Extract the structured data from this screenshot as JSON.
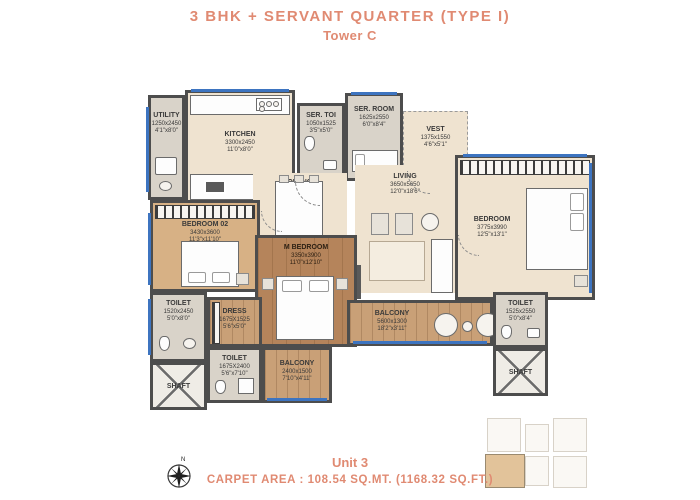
{
  "header": {
    "title": "3 BHK + SERVANT QUARTER (TYPE I)",
    "subtitle": "Tower C"
  },
  "footer": {
    "unit": "Unit 3",
    "carpet_area": "CARPET AREA : 108.54 SQ.MT. (1168.32 SQ.FT.)"
  },
  "colors": {
    "accent": "#E08A72",
    "wall": "#4d4d4d",
    "floor_beige": "#efe3d0",
    "floor_wood": "#c9a077",
    "window_blue": "#3d74c0"
  },
  "compass": {
    "label": "N"
  },
  "rooms": {
    "utility": {
      "name": "UTILITY",
      "mm": "1250x2450",
      "ft": "4'1\"x8'0\""
    },
    "kitchen": {
      "name": "KITCHEN",
      "mm": "3300x2450",
      "ft": "11'0\"x8'0\""
    },
    "ser_toi": {
      "name": "SER. TOI",
      "mm": "1050x1525",
      "ft": "3'5\"x5'0\""
    },
    "ser_room": {
      "name": "SER. ROOM",
      "mm": "1625x2550",
      "ft": "6'0\"x8'4\""
    },
    "vest": {
      "name": "VEST",
      "mm": "1375x1550",
      "ft": "4'6\"x5'1\""
    },
    "dining": {
      "name": "DINING",
      "mm": "3450x3100",
      "ft": "11'4\"x10'2\""
    },
    "living": {
      "name": "LIVING",
      "mm": "3650x5650",
      "ft": "12'0\"x18'6\""
    },
    "bedroom": {
      "name": "BEDROOM",
      "mm": "3775x3990",
      "ft": "12'5\"x13'1\""
    },
    "bedroom02": {
      "name": "BEDROOM 02",
      "mm": "3430x3600",
      "ft": "11'3\"x11'10\""
    },
    "m_bedroom": {
      "name": "M BEDROOM",
      "mm": "3350x3900",
      "ft": "11'0\"x12'10\""
    },
    "toilet_left": {
      "name": "TOILET",
      "mm": "1520x2450",
      "ft": "5'0\"x8'0\""
    },
    "dress": {
      "name": "DRESS",
      "mm": "1675X1525",
      "ft": "5'6\"x5'0\""
    },
    "toilet_mid": {
      "name": "TOILET",
      "mm": "1675X2400",
      "ft": "5'6\"x7'10\""
    },
    "balcony_bottom": {
      "name": "BALCONY",
      "mm": "2400x1500",
      "ft": "7'10\"x4'11\""
    },
    "balcony_right": {
      "name": "BALCONY",
      "mm": "5600x1300",
      "ft": "18'2\"x3'11\""
    },
    "toilet_right": {
      "name": "TOILET",
      "mm": "1525x2550",
      "ft": "5'0\"x8'4\""
    },
    "shaft_left": {
      "name": "SHAFT"
    },
    "shaft_right": {
      "name": "SHAFT"
    }
  }
}
